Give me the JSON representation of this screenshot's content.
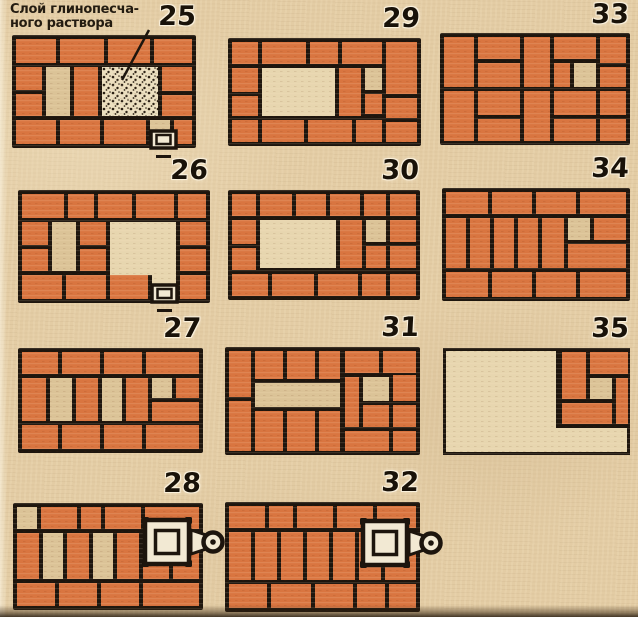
{
  "colors": {
    "paper": "#e3cca4",
    "joint": "#1d150d",
    "brick": "#d97540",
    "light_brick": "#dbc397",
    "opening": "#e7d6af",
    "mortar": "#ebdfbf",
    "dot": "#2a2014",
    "hardware": "#f2e9d3"
  },
  "annotation": {
    "line1": "Слой глинопесча-",
    "line2": "ного раствора",
    "leader": {
      "x1": 149,
      "y1": 30,
      "x2": 122,
      "y2": 80
    }
  },
  "plans": [
    {
      "number": "25",
      "x": 12,
      "y": 35,
      "w": 184,
      "h": 113,
      "num_x": 148,
      "num_y": 2,
      "base": "solid",
      "door": [
        139,
        96
      ],
      "bricks": [
        [
          4,
          4,
          40,
          24,
          "b"
        ],
        [
          48,
          4,
          44,
          24,
          "b"
        ],
        [
          96,
          4,
          42,
          24,
          "b"
        ],
        [
          142,
          4,
          38,
          24,
          "b"
        ],
        [
          4,
          32,
          26,
          23,
          "b"
        ],
        [
          4,
          59,
          26,
          22,
          "b"
        ],
        [
          34,
          32,
          24,
          49,
          "l"
        ],
        [
          62,
          32,
          24,
          49,
          "b"
        ],
        [
          90,
          32,
          56,
          49,
          "m"
        ],
        [
          150,
          32,
          30,
          24,
          "b"
        ],
        [
          150,
          60,
          30,
          21,
          "b"
        ],
        [
          4,
          85,
          40,
          24,
          "b"
        ],
        [
          48,
          85,
          40,
          24,
          "b"
        ],
        [
          92,
          85,
          42,
          24,
          "b"
        ],
        [
          138,
          85,
          20,
          24,
          "l"
        ],
        [
          162,
          85,
          18,
          24,
          "b"
        ]
      ]
    },
    {
      "number": "26",
      "x": 18,
      "y": 190,
      "w": 192,
      "h": 113,
      "num_x": 160,
      "num_y": 156,
      "base": "solid",
      "door": [
        134,
        95
      ],
      "bricks": [
        [
          4,
          4,
          42,
          24,
          "b"
        ],
        [
          50,
          4,
          26,
          24,
          "b"
        ],
        [
          80,
          4,
          34,
          24,
          "b"
        ],
        [
          118,
          4,
          38,
          24,
          "b"
        ],
        [
          160,
          4,
          28,
          24,
          "b"
        ],
        [
          4,
          32,
          26,
          23,
          "b"
        ],
        [
          4,
          59,
          26,
          22,
          "b"
        ],
        [
          34,
          32,
          24,
          49,
          "l"
        ],
        [
          62,
          32,
          26,
          23,
          "b"
        ],
        [
          62,
          59,
          26,
          22,
          "b"
        ],
        [
          92,
          32,
          66,
          53,
          "o"
        ],
        [
          134,
          85,
          24,
          24,
          "o"
        ],
        [
          162,
          32,
          26,
          23,
          "b"
        ],
        [
          162,
          59,
          26,
          22,
          "b"
        ],
        [
          162,
          85,
          26,
          24,
          "b"
        ],
        [
          4,
          85,
          40,
          24,
          "b"
        ],
        [
          48,
          85,
          40,
          24,
          "b"
        ],
        [
          92,
          85,
          38,
          24,
          "b"
        ]
      ]
    },
    {
      "number": "27",
      "x": 18,
      "y": 348,
      "w": 185,
      "h": 105,
      "num_x": 153,
      "num_y": 314,
      "base": "solid",
      "bricks": [
        [
          4,
          4,
          36,
          22,
          "b"
        ],
        [
          44,
          4,
          38,
          22,
          "b"
        ],
        [
          86,
          4,
          38,
          22,
          "b"
        ],
        [
          128,
          4,
          53,
          22,
          "b"
        ],
        [
          4,
          30,
          24,
          43,
          "b"
        ],
        [
          32,
          30,
          22,
          43,
          "l"
        ],
        [
          58,
          30,
          22,
          43,
          "b"
        ],
        [
          84,
          30,
          20,
          43,
          "l"
        ],
        [
          108,
          30,
          22,
          43,
          "b"
        ],
        [
          134,
          30,
          20,
          20,
          "l"
        ],
        [
          158,
          30,
          23,
          20,
          "b"
        ],
        [
          134,
          54,
          47,
          19,
          "b"
        ],
        [
          4,
          77,
          36,
          24,
          "b"
        ],
        [
          44,
          77,
          38,
          24,
          "b"
        ],
        [
          86,
          77,
          38,
          24,
          "b"
        ],
        [
          128,
          77,
          53,
          24,
          "b"
        ]
      ]
    },
    {
      "number": "28",
      "x": 13,
      "y": 503,
      "w": 190,
      "h": 107,
      "num_x": 153,
      "num_y": 469,
      "base": "solid",
      "damper": [
        132,
        17
      ],
      "bricks": [
        [
          4,
          4,
          20,
          22,
          "l"
        ],
        [
          28,
          4,
          36,
          22,
          "b"
        ],
        [
          68,
          4,
          20,
          22,
          "b"
        ],
        [
          92,
          4,
          36,
          22,
          "b"
        ],
        [
          132,
          4,
          54,
          22,
          "b"
        ],
        [
          4,
          30,
          22,
          46,
          "b"
        ],
        [
          30,
          30,
          20,
          46,
          "l"
        ],
        [
          54,
          30,
          22,
          46,
          "b"
        ],
        [
          80,
          30,
          20,
          46,
          "l"
        ],
        [
          104,
          30,
          22,
          46,
          "b"
        ],
        [
          130,
          30,
          26,
          46,
          "b"
        ],
        [
          160,
          30,
          26,
          46,
          "b"
        ],
        [
          4,
          80,
          38,
          23,
          "b"
        ],
        [
          46,
          80,
          38,
          23,
          "b"
        ],
        [
          88,
          80,
          38,
          23,
          "b"
        ],
        [
          130,
          80,
          56,
          23,
          "b"
        ]
      ]
    },
    {
      "number": "29",
      "x": 228,
      "y": 38,
      "w": 193,
      "h": 108,
      "num_x": 372,
      "num_y": 4,
      "base": "solid",
      "bricks": [
        [
          4,
          4,
          26,
          22,
          "b"
        ],
        [
          34,
          4,
          44,
          22,
          "b"
        ],
        [
          82,
          4,
          28,
          22,
          "b"
        ],
        [
          114,
          4,
          40,
          22,
          "b"
        ],
        [
          158,
          4,
          31,
          52,
          "b"
        ],
        [
          4,
          30,
          26,
          24,
          "b"
        ],
        [
          4,
          58,
          26,
          20,
          "b"
        ],
        [
          34,
          30,
          73,
          48,
          "o"
        ],
        [
          111,
          30,
          22,
          48,
          "b"
        ],
        [
          137,
          30,
          17,
          22,
          "l"
        ],
        [
          137,
          56,
          17,
          20,
          "b"
        ],
        [
          158,
          60,
          31,
          20,
          "b"
        ],
        [
          4,
          82,
          26,
          22,
          "b"
        ],
        [
          34,
          82,
          42,
          22,
          "b"
        ],
        [
          80,
          82,
          44,
          22,
          "b"
        ],
        [
          128,
          82,
          26,
          22,
          "b"
        ],
        [
          158,
          84,
          31,
          20,
          "b"
        ]
      ]
    },
    {
      "number": "30",
      "x": 228,
      "y": 190,
      "w": 192,
      "h": 110,
      "num_x": 371,
      "num_y": 156,
      "base": "solid",
      "bricks": [
        [
          4,
          4,
          24,
          22,
          "b"
        ],
        [
          32,
          4,
          32,
          22,
          "b"
        ],
        [
          68,
          4,
          30,
          22,
          "b"
        ],
        [
          102,
          4,
          30,
          22,
          "b"
        ],
        [
          136,
          4,
          22,
          22,
          "b"
        ],
        [
          162,
          4,
          26,
          22,
          "b"
        ],
        [
          4,
          30,
          24,
          24,
          "b"
        ],
        [
          4,
          58,
          24,
          22,
          "b"
        ],
        [
          32,
          30,
          76,
          48,
          "o"
        ],
        [
          112,
          30,
          22,
          48,
          "b"
        ],
        [
          138,
          30,
          20,
          22,
          "l"
        ],
        [
          162,
          30,
          26,
          22,
          "b"
        ],
        [
          138,
          56,
          20,
          22,
          "b"
        ],
        [
          162,
          56,
          26,
          22,
          "b"
        ],
        [
          4,
          84,
          36,
          22,
          "b"
        ],
        [
          44,
          84,
          42,
          22,
          "b"
        ],
        [
          90,
          84,
          40,
          22,
          "b"
        ],
        [
          134,
          84,
          24,
          22,
          "b"
        ],
        [
          162,
          84,
          26,
          22,
          "b"
        ]
      ]
    },
    {
      "number": "31",
      "x": 225,
      "y": 347,
      "w": 195,
      "h": 108,
      "num_x": 371,
      "num_y": 313,
      "base": "solid",
      "bricks": [
        [
          4,
          4,
          22,
          46,
          "b"
        ],
        [
          4,
          54,
          22,
          50,
          "b"
        ],
        [
          30,
          4,
          28,
          28,
          "b"
        ],
        [
          62,
          4,
          28,
          28,
          "b"
        ],
        [
          94,
          4,
          21,
          28,
          "b"
        ],
        [
          30,
          36,
          85,
          24,
          "l"
        ],
        [
          30,
          64,
          28,
          40,
          "b"
        ],
        [
          62,
          64,
          28,
          40,
          "b"
        ],
        [
          94,
          64,
          21,
          40,
          "b"
        ],
        [
          120,
          4,
          34,
          22,
          "b"
        ],
        [
          158,
          4,
          33,
          22,
          "b"
        ],
        [
          120,
          30,
          14,
          50,
          "b"
        ],
        [
          138,
          30,
          26,
          24,
          "l"
        ],
        [
          168,
          28,
          23,
          26,
          "b"
        ],
        [
          138,
          58,
          26,
          22,
          "b"
        ],
        [
          168,
          58,
          23,
          22,
          "b"
        ],
        [
          120,
          84,
          44,
          20,
          "b"
        ],
        [
          168,
          84,
          23,
          20,
          "b"
        ]
      ]
    },
    {
      "number": "32",
      "x": 225,
      "y": 502,
      "w": 195,
      "h": 110,
      "num_x": 371,
      "num_y": 468,
      "base": "solid",
      "damper": [
        138,
        19
      ],
      "bricks": [
        [
          4,
          4,
          36,
          22,
          "b"
        ],
        [
          44,
          4,
          24,
          22,
          "b"
        ],
        [
          72,
          4,
          36,
          22,
          "b"
        ],
        [
          112,
          4,
          36,
          22,
          "b"
        ],
        [
          152,
          4,
          39,
          22,
          "b"
        ],
        [
          4,
          30,
          22,
          48,
          "b"
        ],
        [
          30,
          30,
          22,
          48,
          "b"
        ],
        [
          56,
          30,
          22,
          48,
          "b"
        ],
        [
          82,
          30,
          22,
          48,
          "b"
        ],
        [
          108,
          30,
          22,
          48,
          "b"
        ],
        [
          134,
          30,
          22,
          48,
          "b"
        ],
        [
          160,
          30,
          31,
          48,
          "b"
        ],
        [
          4,
          82,
          38,
          24,
          "b"
        ],
        [
          46,
          82,
          40,
          24,
          "b"
        ],
        [
          90,
          82,
          38,
          24,
          "b"
        ],
        [
          132,
          82,
          28,
          24,
          "b"
        ],
        [
          164,
          82,
          27,
          24,
          "b"
        ]
      ]
    },
    {
      "number": "33",
      "x": 440,
      "y": 33,
      "w": 190,
      "h": 112,
      "num_x": 581,
      "num_y": 0,
      "base": "solid",
      "bricks": [
        [
          4,
          4,
          30,
          50,
          "b"
        ],
        [
          4,
          58,
          30,
          50,
          "b"
        ],
        [
          38,
          4,
          42,
          22,
          "b"
        ],
        [
          38,
          30,
          42,
          24,
          "b"
        ],
        [
          38,
          58,
          42,
          24,
          "b"
        ],
        [
          38,
          86,
          42,
          22,
          "b"
        ],
        [
          84,
          4,
          26,
          50,
          "b"
        ],
        [
          84,
          58,
          26,
          50,
          "b"
        ],
        [
          114,
          4,
          42,
          22,
          "b"
        ],
        [
          160,
          4,
          26,
          26,
          "b"
        ],
        [
          114,
          30,
          16,
          24,
          "b"
        ],
        [
          134,
          30,
          22,
          24,
          "l"
        ],
        [
          160,
          34,
          26,
          20,
          "b"
        ],
        [
          114,
          58,
          42,
          24,
          "b"
        ],
        [
          160,
          58,
          26,
          24,
          "b"
        ],
        [
          114,
          86,
          42,
          22,
          "b"
        ],
        [
          160,
          86,
          26,
          22,
          "b"
        ]
      ]
    },
    {
      "number": "34",
      "x": 442,
      "y": 188,
      "w": 188,
      "h": 113,
      "num_x": 581,
      "num_y": 154,
      "base": "solid",
      "bricks": [
        [
          4,
          4,
          42,
          22,
          "b"
        ],
        [
          50,
          4,
          40,
          22,
          "b"
        ],
        [
          94,
          4,
          40,
          22,
          "b"
        ],
        [
          138,
          4,
          46,
          22,
          "b"
        ],
        [
          4,
          30,
          20,
          50,
          "b"
        ],
        [
          28,
          30,
          20,
          50,
          "b"
        ],
        [
          52,
          30,
          20,
          50,
          "b"
        ],
        [
          76,
          30,
          20,
          50,
          "b"
        ],
        [
          100,
          30,
          22,
          50,
          "b"
        ],
        [
          126,
          30,
          22,
          22,
          "l"
        ],
        [
          152,
          30,
          32,
          22,
          "b"
        ],
        [
          126,
          56,
          58,
          24,
          "b"
        ],
        [
          4,
          84,
          42,
          25,
          "b"
        ],
        [
          50,
          84,
          40,
          25,
          "b"
        ],
        [
          94,
          84,
          40,
          25,
          "b"
        ],
        [
          138,
          84,
          46,
          25,
          "b"
        ]
      ]
    },
    {
      "number": "35",
      "x": 443,
      "y": 348,
      "w": 187,
      "h": 107,
      "num_x": 581,
      "num_y": 314,
      "base": "outline",
      "cluster": [
        113,
        0,
        74,
        80
      ],
      "bricks": [
        [
          119,
          4,
          24,
          47,
          "b"
        ],
        [
          147,
          4,
          38,
          22,
          "b"
        ],
        [
          147,
          30,
          22,
          21,
          "l"
        ],
        [
          173,
          30,
          12,
          46,
          "b"
        ],
        [
          119,
          55,
          50,
          21,
          "b"
        ]
      ]
    }
  ]
}
